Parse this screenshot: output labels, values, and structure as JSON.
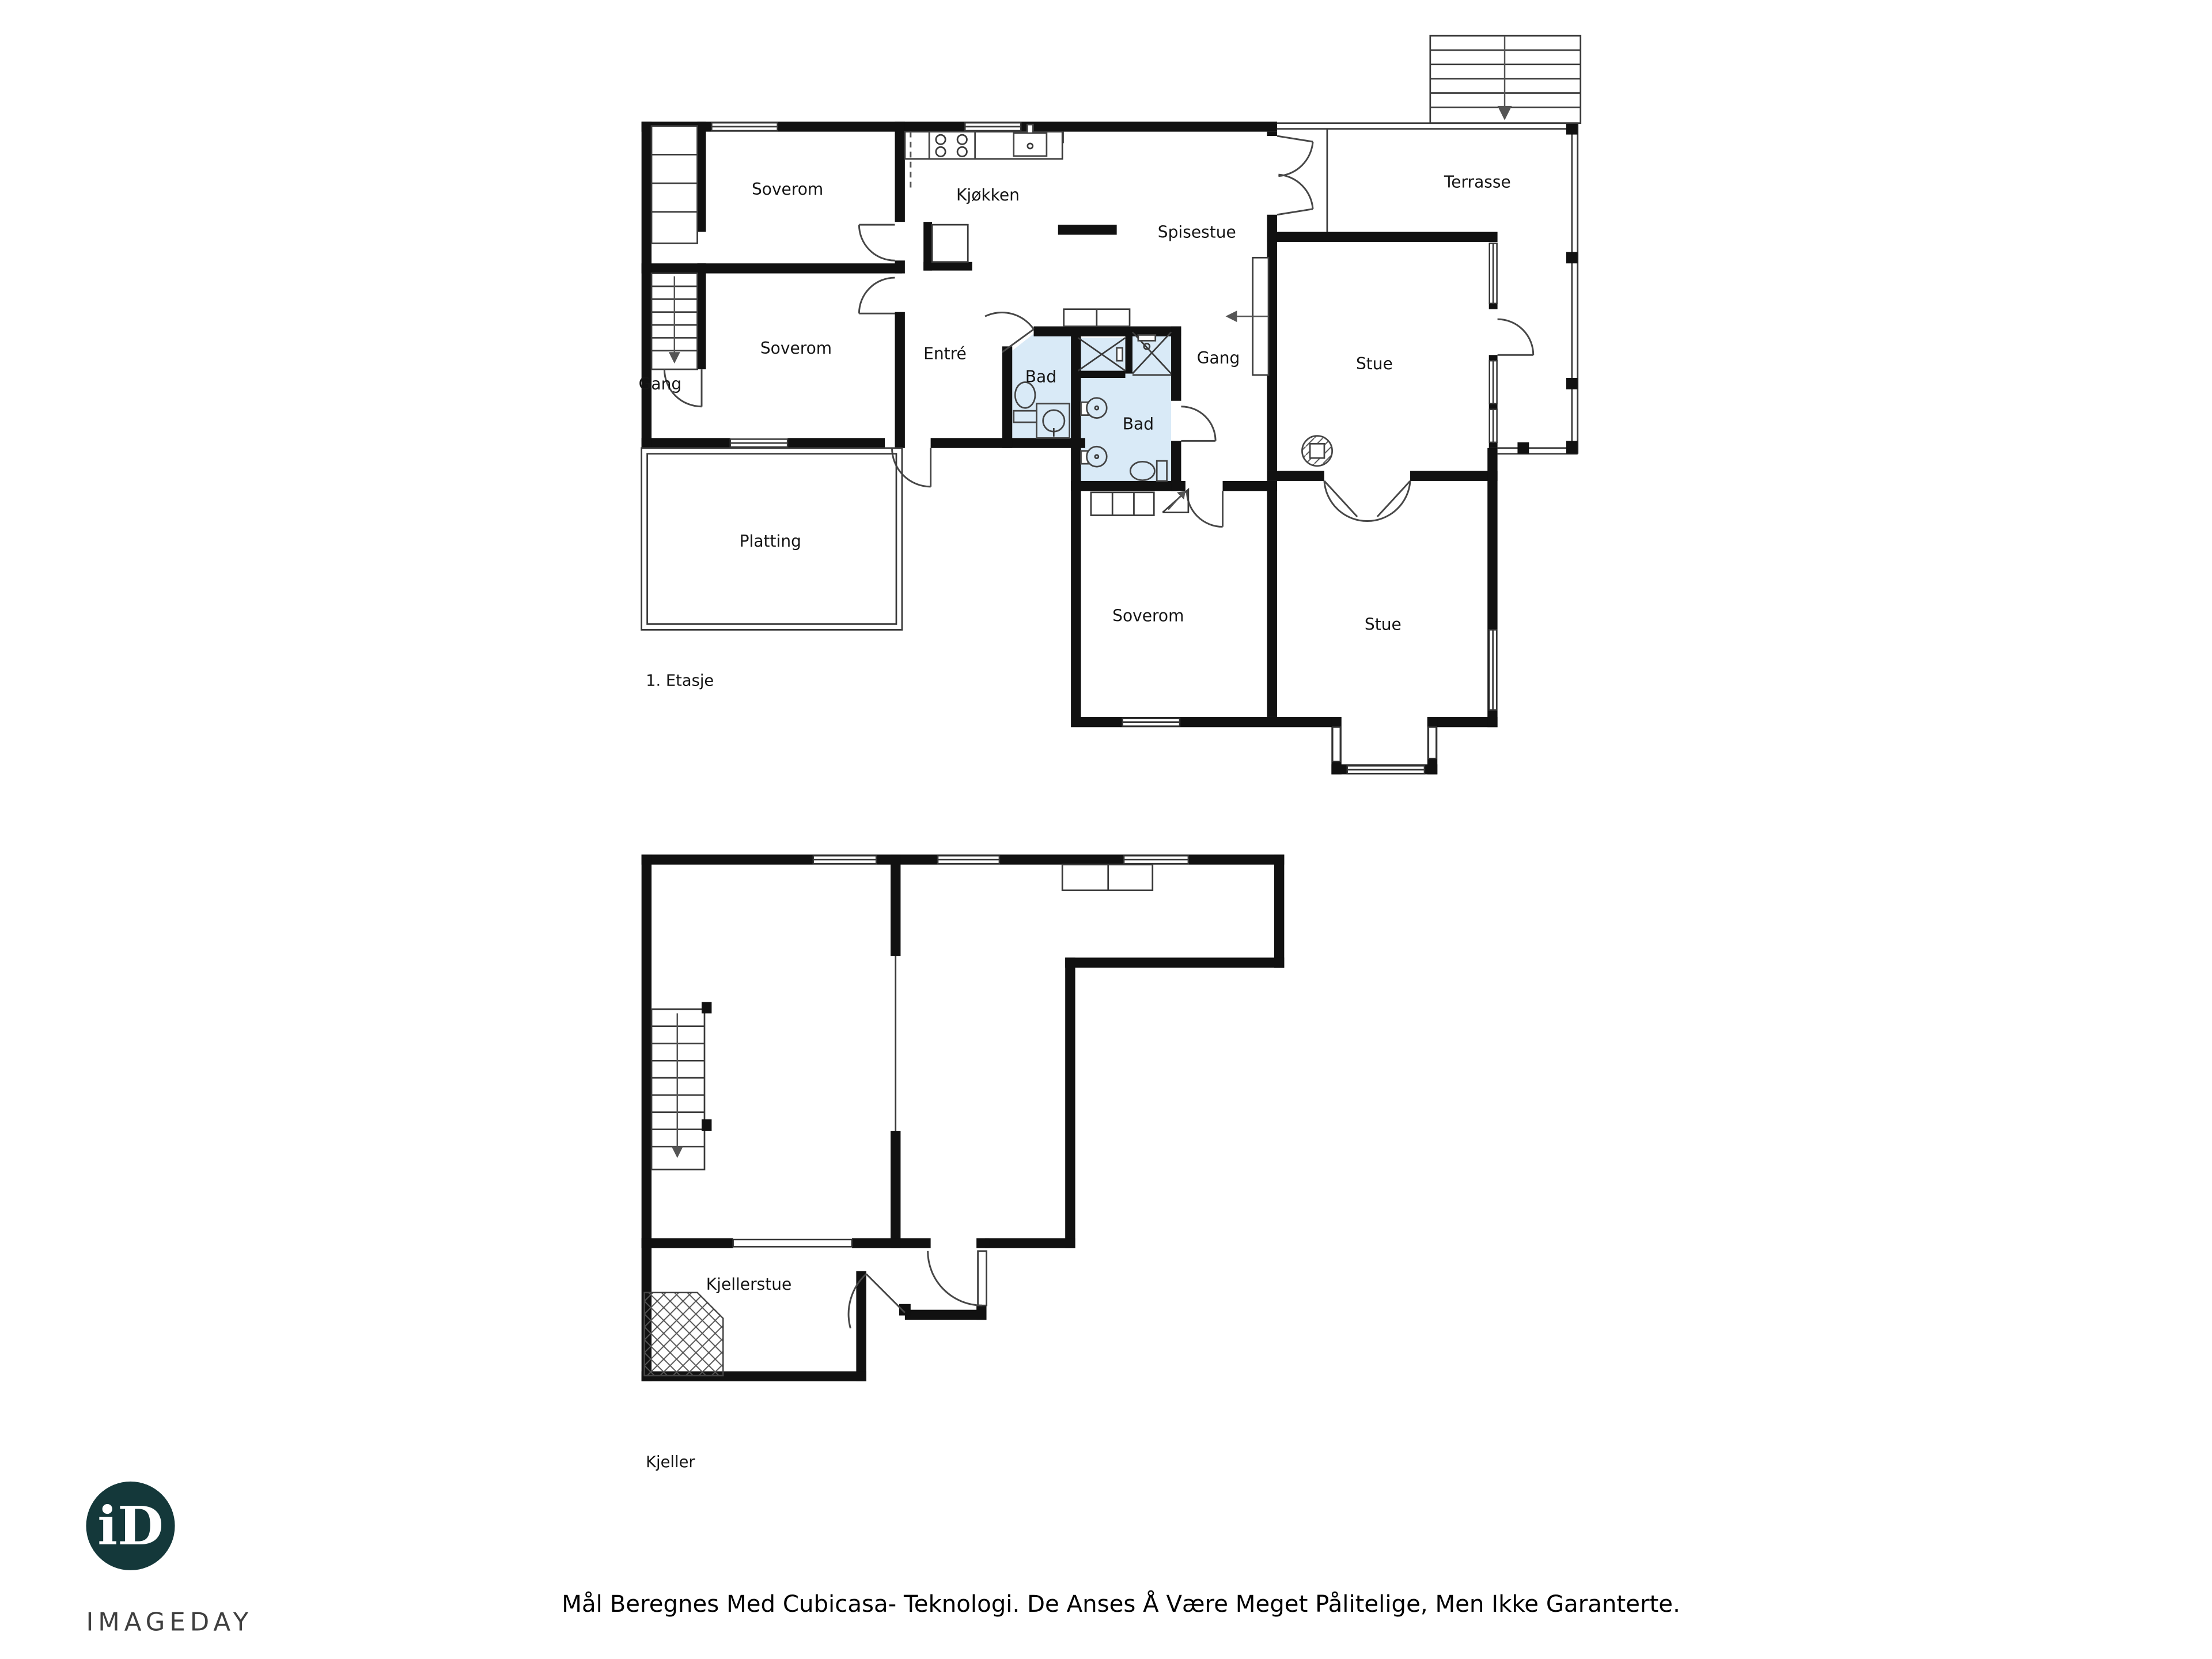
{
  "document": {
    "type": "floorplan"
  },
  "floor1": {
    "name": "1. Etasje",
    "rooms": [
      {
        "id": "soverom-1",
        "label": "Soverom"
      },
      {
        "id": "soverom-2",
        "label": "Soverom"
      },
      {
        "id": "gang-left",
        "label": "Gang"
      },
      {
        "id": "entre",
        "label": "Entré"
      },
      {
        "id": "kjokken",
        "label": "Kjøkken"
      },
      {
        "id": "spisestue",
        "label": "Spisestue"
      },
      {
        "id": "bad-1",
        "label": "Bad"
      },
      {
        "id": "bad-2",
        "label": "Bad"
      },
      {
        "id": "gang-mid",
        "label": "Gang"
      },
      {
        "id": "stue-upper",
        "label": "Stue"
      },
      {
        "id": "terrasse",
        "label": "Terrasse"
      },
      {
        "id": "soverom-lower",
        "label": "Soverom"
      },
      {
        "id": "stue-lower",
        "label": "Stue"
      },
      {
        "id": "platting",
        "label": "Platting"
      }
    ]
  },
  "basement": {
    "name": "Kjeller",
    "rooms": [
      {
        "id": "kjellerstue",
        "label": "Kjellerstue"
      }
    ]
  },
  "logo": {
    "monogram": "iD",
    "wordmark": "IMAGEDAY"
  },
  "footer": {
    "disclaimer": "Mål Beregnes Med Cubicasa- Teknologi. De Anses Å Være Meget Pålitelige, Men Ikke Garanterte."
  },
  "colors": {
    "wall": "#111111",
    "bathroom_fill": "#d9eaf7",
    "logo_background": "#14383a",
    "logo_text": "#ffffff"
  }
}
